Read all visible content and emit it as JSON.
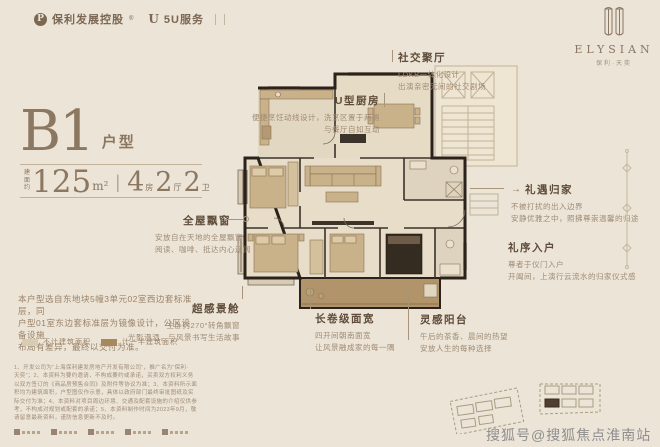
{
  "colors": {
    "background": "#ebe4d7",
    "accent": "#8c7761",
    "wall": "#2b231b",
    "balcony_fill": "#b2946a",
    "light_fill": "#e7ddc8"
  },
  "brand": {
    "developer_logo_letter": "P",
    "developer": "保利发展控股",
    "reg_mark": "®",
    "service_logo_letter": "U",
    "service": "5U服务"
  },
  "elysian": {
    "wordmark": "ELYSIAN",
    "subtitle": "保利·天奕"
  },
  "unit": {
    "code": "B1",
    "type_label": "户型",
    "area_prefix_top": "建面",
    "area_prefix_bottom": "约",
    "area_value": "125",
    "area_unit": "m²",
    "divider": "|",
    "rooms": [
      {
        "num": "4",
        "label": "房"
      },
      {
        "num": "2",
        "label": "厅"
      },
      {
        "num": "2",
        "label": "卫"
      }
    ]
  },
  "description": {
    "lines": [
      "本户型选自东地块5幢3单元02室西边套标准层，同",
      "户型01室东边套标准层为镜像设计，公区设备设施",
      "布局有差异，最终以交付为准。"
    ]
  },
  "legend": {
    "items": [
      {
        "label": "不计建筑面积",
        "color": "#d8ccb5"
      },
      {
        "label": "计一半建筑面积",
        "color": "#a8895e"
      }
    ]
  },
  "callouts": [
    {
      "title": "社交聚厅",
      "lines": [
        "LDKB一体化设计",
        "出演亲密无间的社交剧场"
      ]
    },
    {
      "title": "U型厨房",
      "lines": [
        "便捷烹饪动线设计，洗烹区置于两侧",
        "与餐厅自如互动"
      ]
    },
    {
      "title": "全屋飘窗",
      "lines": [
        "安放自在天地的全屋飘窗",
        "阅读、咖啡、抵达内心辽阔"
      ]
    },
    {
      "title": "礼遇归家",
      "arrow": "→",
      "lines": [
        "不被打扰的出入边界",
        "安静优雅之中，照拂尊崇温馨的归途"
      ]
    },
    {
      "title": "礼序入户",
      "lines": [
        "尊者于仪门入户",
        "开阖间，上演行云流水的归家仪式感"
      ]
    },
    {
      "title": "超感景舱",
      "lines": [
        "主卧约270°转角飘窗",
        "光影漫洒，与风景书写生活故事"
      ]
    },
    {
      "title": "长卷级面宽",
      "lines": [
        "四开间朝南面宽",
        "让风景融成家的每一隅"
      ]
    },
    {
      "title": "灵感阳台",
      "lines": [
        "午后的茶香、晨间的热望",
        "安放人生的每种选择"
      ]
    }
  ],
  "disclaimer": {
    "lines": [
      "1、开发公司为“上海保利建发房地产开发有限公司”，推广名为“保利·",
      "天奕”；2、本资料为要约邀请，不构成要约或承诺，买卖双方权利义务",
      "以双方签订的《商品房预售合同》及附件等协议为准；3、本资料所示面",
      "积均为建筑面积，户型图仅作示意，具体以政府部门最终审批图纸及实",
      "际交付为准；4、本资料对项目周边环境、交通及配套设施的介绍仅供参",
      "考，不构成对规划或配套的承诺；5、本资料制作时间为2023年9月，敬",
      "请留意最新资料，谨防信息更新不及时。"
    ]
  },
  "watermark": "搜狐号@搜狐焦点淮南站"
}
